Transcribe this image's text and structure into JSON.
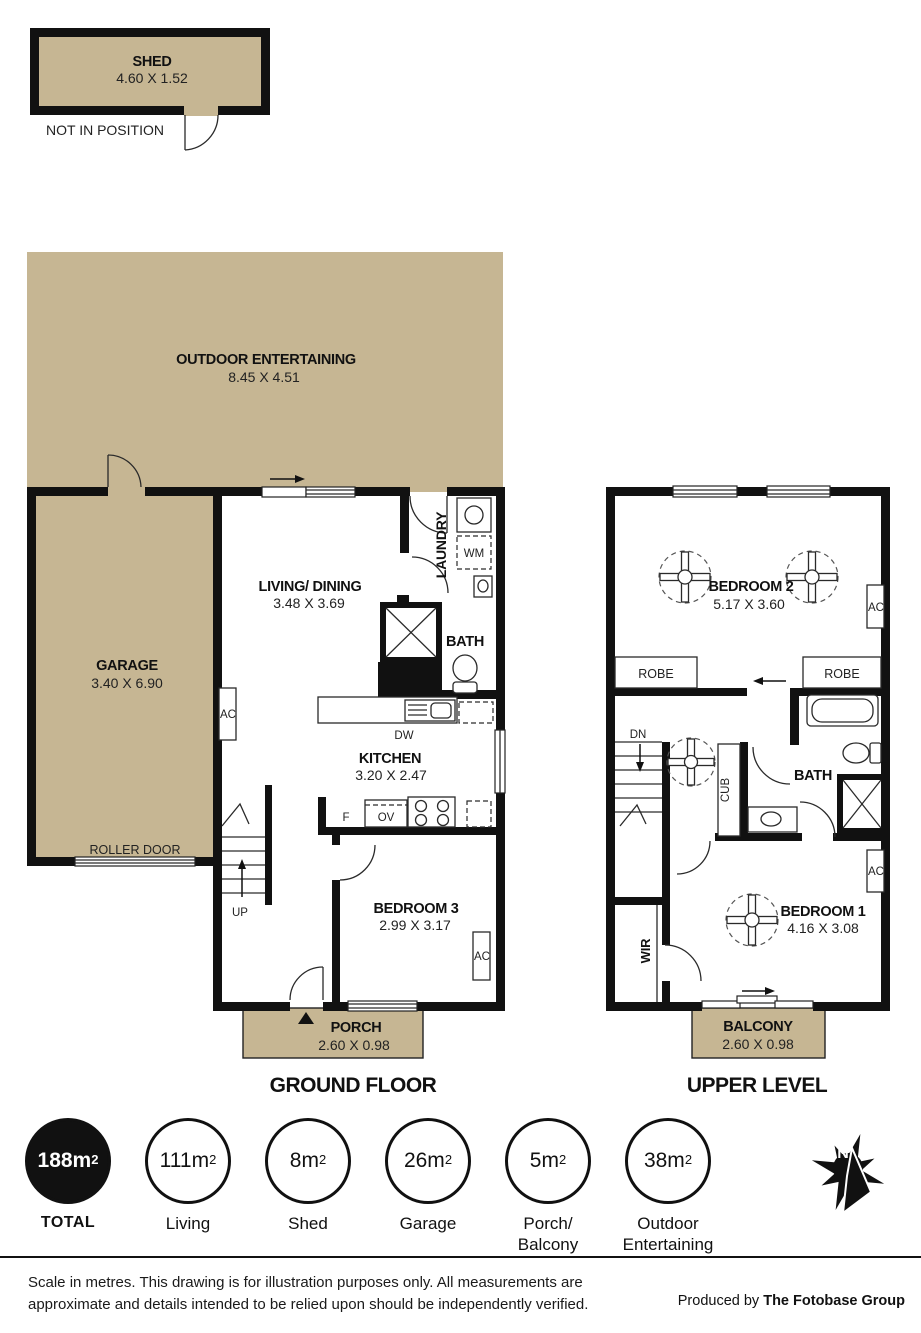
{
  "colors": {
    "area_fill": "#c6b693",
    "wall": "#111111"
  },
  "shed": {
    "name": "SHED",
    "dims": "4.60 X 1.52",
    "note": "NOT IN POSITION"
  },
  "outdoor": {
    "name": "OUTDOOR ENTERTAINING",
    "dims": "8.45 X 4.51"
  },
  "ground_floor": {
    "title": "GROUND FLOOR",
    "garage": {
      "name": "GARAGE",
      "dims": "3.40 X 6.90"
    },
    "living": {
      "name": "LIVING/ DINING",
      "dims": "3.48 X 3.69"
    },
    "kitchen": {
      "name": "KITCHEN",
      "dims": "3.20 X 2.47"
    },
    "bedroom3": {
      "name": "BEDROOM 3",
      "dims": "2.99 X 3.17"
    },
    "bath": "BATH",
    "laundry": "LAUNDRY",
    "porch": {
      "name": "PORCH",
      "dims": "2.60 X 0.98"
    },
    "roller_door": "ROLLER DOOR",
    "up": "UP"
  },
  "upper_level": {
    "title": "UPPER LEVEL",
    "bedroom2": {
      "name": "BEDROOM 2",
      "dims": "5.17 X 3.60"
    },
    "bedroom1": {
      "name": "BEDROOM 1",
      "dims": "4.16 X 3.08"
    },
    "bath": "BATH",
    "balcony": {
      "name": "BALCONY",
      "dims": "2.60 X 0.98"
    },
    "robe": "ROBE",
    "dn": "DN",
    "cub": "CUB",
    "wir": "WIR"
  },
  "fixtures": {
    "ac": "AC",
    "wm": "WM",
    "dw": "DW",
    "fridge": "F",
    "oven": "OV"
  },
  "compass": {
    "north": "N"
  },
  "legend": [
    {
      "value": "188m",
      "sup": "2",
      "line1": "TOTAL",
      "line2": ""
    },
    {
      "value": "111m",
      "sup": "2",
      "line1": "Living",
      "line2": ""
    },
    {
      "value": "8m",
      "sup": "2",
      "line1": "Shed",
      "line2": ""
    },
    {
      "value": "26m",
      "sup": "2",
      "line1": "Garage",
      "line2": ""
    },
    {
      "value": "5m",
      "sup": "2",
      "line1": "Porch/",
      "line2": "Balcony"
    },
    {
      "value": "38m",
      "sup": "2",
      "line1": "Outdoor",
      "line2": "Entertaining"
    }
  ],
  "footer": {
    "disclaimer_line1": "Scale in metres. This drawing is for illustration purposes only. All measurements are",
    "disclaimer_line2": "approximate and details intended to be relied upon should be independently verified.",
    "produced_by": "Produced by",
    "producer": "The Fotobase Group"
  }
}
